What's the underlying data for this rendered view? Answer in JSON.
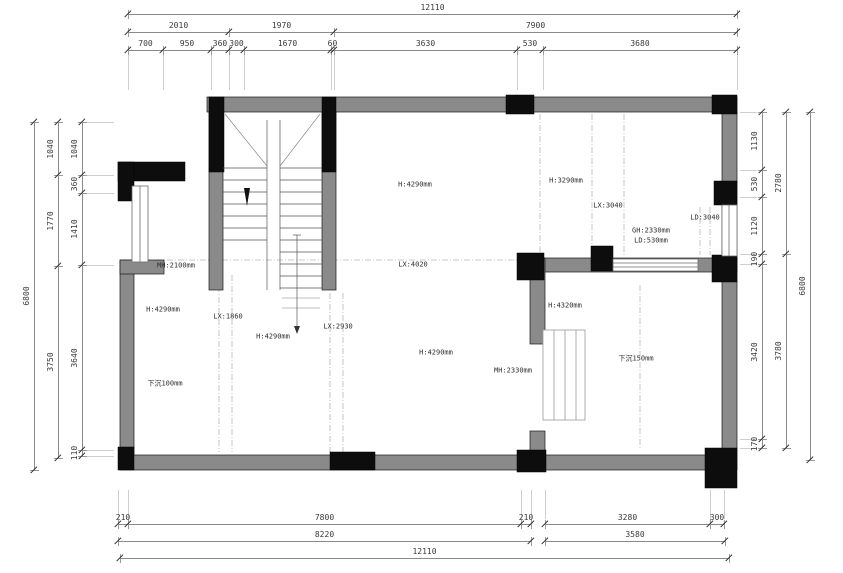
{
  "plan": {
    "labels": [
      {
        "text": "H:4290mm",
        "x": 415,
        "y": 185
      },
      {
        "text": "H:3290mm",
        "x": 566,
        "y": 181
      },
      {
        "text": "LX:3040",
        "x": 608,
        "y": 206
      },
      {
        "text": "LD:3040",
        "x": 705,
        "y": 218
      },
      {
        "text": "GH:2330mm",
        "x": 651,
        "y": 231
      },
      {
        "text": "LD:530mm",
        "x": 651,
        "y": 241
      },
      {
        "text": "MH:2100mm",
        "x": 176,
        "y": 266
      },
      {
        "text": "H:4290mm",
        "x": 163,
        "y": 310
      },
      {
        "text": "LX:1860",
        "x": 228,
        "y": 317
      },
      {
        "text": "H:4290mm",
        "x": 273,
        "y": 337
      },
      {
        "text": "LX:2930",
        "x": 338,
        "y": 327
      },
      {
        "text": "LX:4020",
        "x": 413,
        "y": 265
      },
      {
        "text": "H:4290mm",
        "x": 436,
        "y": 353
      },
      {
        "text": "MH:2330mm",
        "x": 513,
        "y": 371
      },
      {
        "text": "H:4320mm",
        "x": 565,
        "y": 306
      },
      {
        "text": "下沉150mm",
        "x": 636,
        "y": 359
      },
      {
        "text": "下沉100mm",
        "x": 165,
        "y": 384
      }
    ]
  },
  "dimensions": {
    "chains": [
      {
        "dir": "h",
        "pos": 14,
        "ticks": [
          128,
          737
        ],
        "values": [
          "12110"
        ]
      },
      {
        "dir": "h",
        "pos": 32,
        "ticks": [
          128,
          229,
          334,
          737
        ],
        "values": [
          "2010",
          "1970",
          "7900"
        ]
      },
      {
        "dir": "h",
        "pos": 50,
        "ticks": [
          128,
          163,
          211,
          229,
          244,
          331,
          334,
          517,
          543,
          737
        ],
        "values": [
          "700",
          "950",
          "360",
          "300",
          "1670",
          "60",
          "3630",
          "530",
          "3680"
        ],
        "ext": 40
      },
      {
        "dir": "h",
        "pos": 524,
        "ticks": [
          118,
          128,
          521,
          531
        ],
        "values": [
          "210",
          "7800",
          "210"
        ],
        "ext": -34
      },
      {
        "dir": "h",
        "pos": 524,
        "ticks": [
          545,
          710,
          724
        ],
        "values": [
          "3280",
          "300"
        ],
        "ext": -34
      },
      {
        "dir": "h",
        "pos": 541,
        "ticks": [
          118,
          531
        ],
        "values": [
          "8220"
        ]
      },
      {
        "dir": "h",
        "pos": 541,
        "ticks": [
          545,
          725
        ],
        "values": [
          "3580"
        ]
      },
      {
        "dir": "h",
        "pos": 558,
        "ticks": [
          120,
          729
        ],
        "values": [
          "12110"
        ]
      },
      {
        "dir": "v",
        "pos": 34,
        "ticks": [
          122,
          470
        ],
        "values": [
          "6800"
        ]
      },
      {
        "dir": "v",
        "pos": 58,
        "ticks": [
          122,
          175,
          266,
          458
        ],
        "values": [
          "1040",
          "1770",
          "3750"
        ]
      },
      {
        "dir": "v",
        "pos": 82,
        "ticks": [
          122,
          175,
          193,
          265,
          450,
          456
        ],
        "values": [
          "1040",
          "360",
          "1410",
          "3640",
          "110"
        ],
        "ext": 32
      },
      {
        "dir": "v",
        "pos": 762,
        "ticks": [
          112,
          170,
          197,
          254,
          264,
          439,
          448
        ],
        "values": [
          "1130",
          "530",
          "1120",
          "190",
          "3420",
          "170"
        ],
        "ext": -22
      },
      {
        "dir": "v",
        "pos": 786,
        "ticks": [
          112,
          254,
          448
        ],
        "values": [
          "2780",
          "3780"
        ]
      },
      {
        "dir": "v",
        "pos": 810,
        "ticks": [
          112,
          460
        ],
        "values": [
          "6800"
        ]
      }
    ]
  }
}
